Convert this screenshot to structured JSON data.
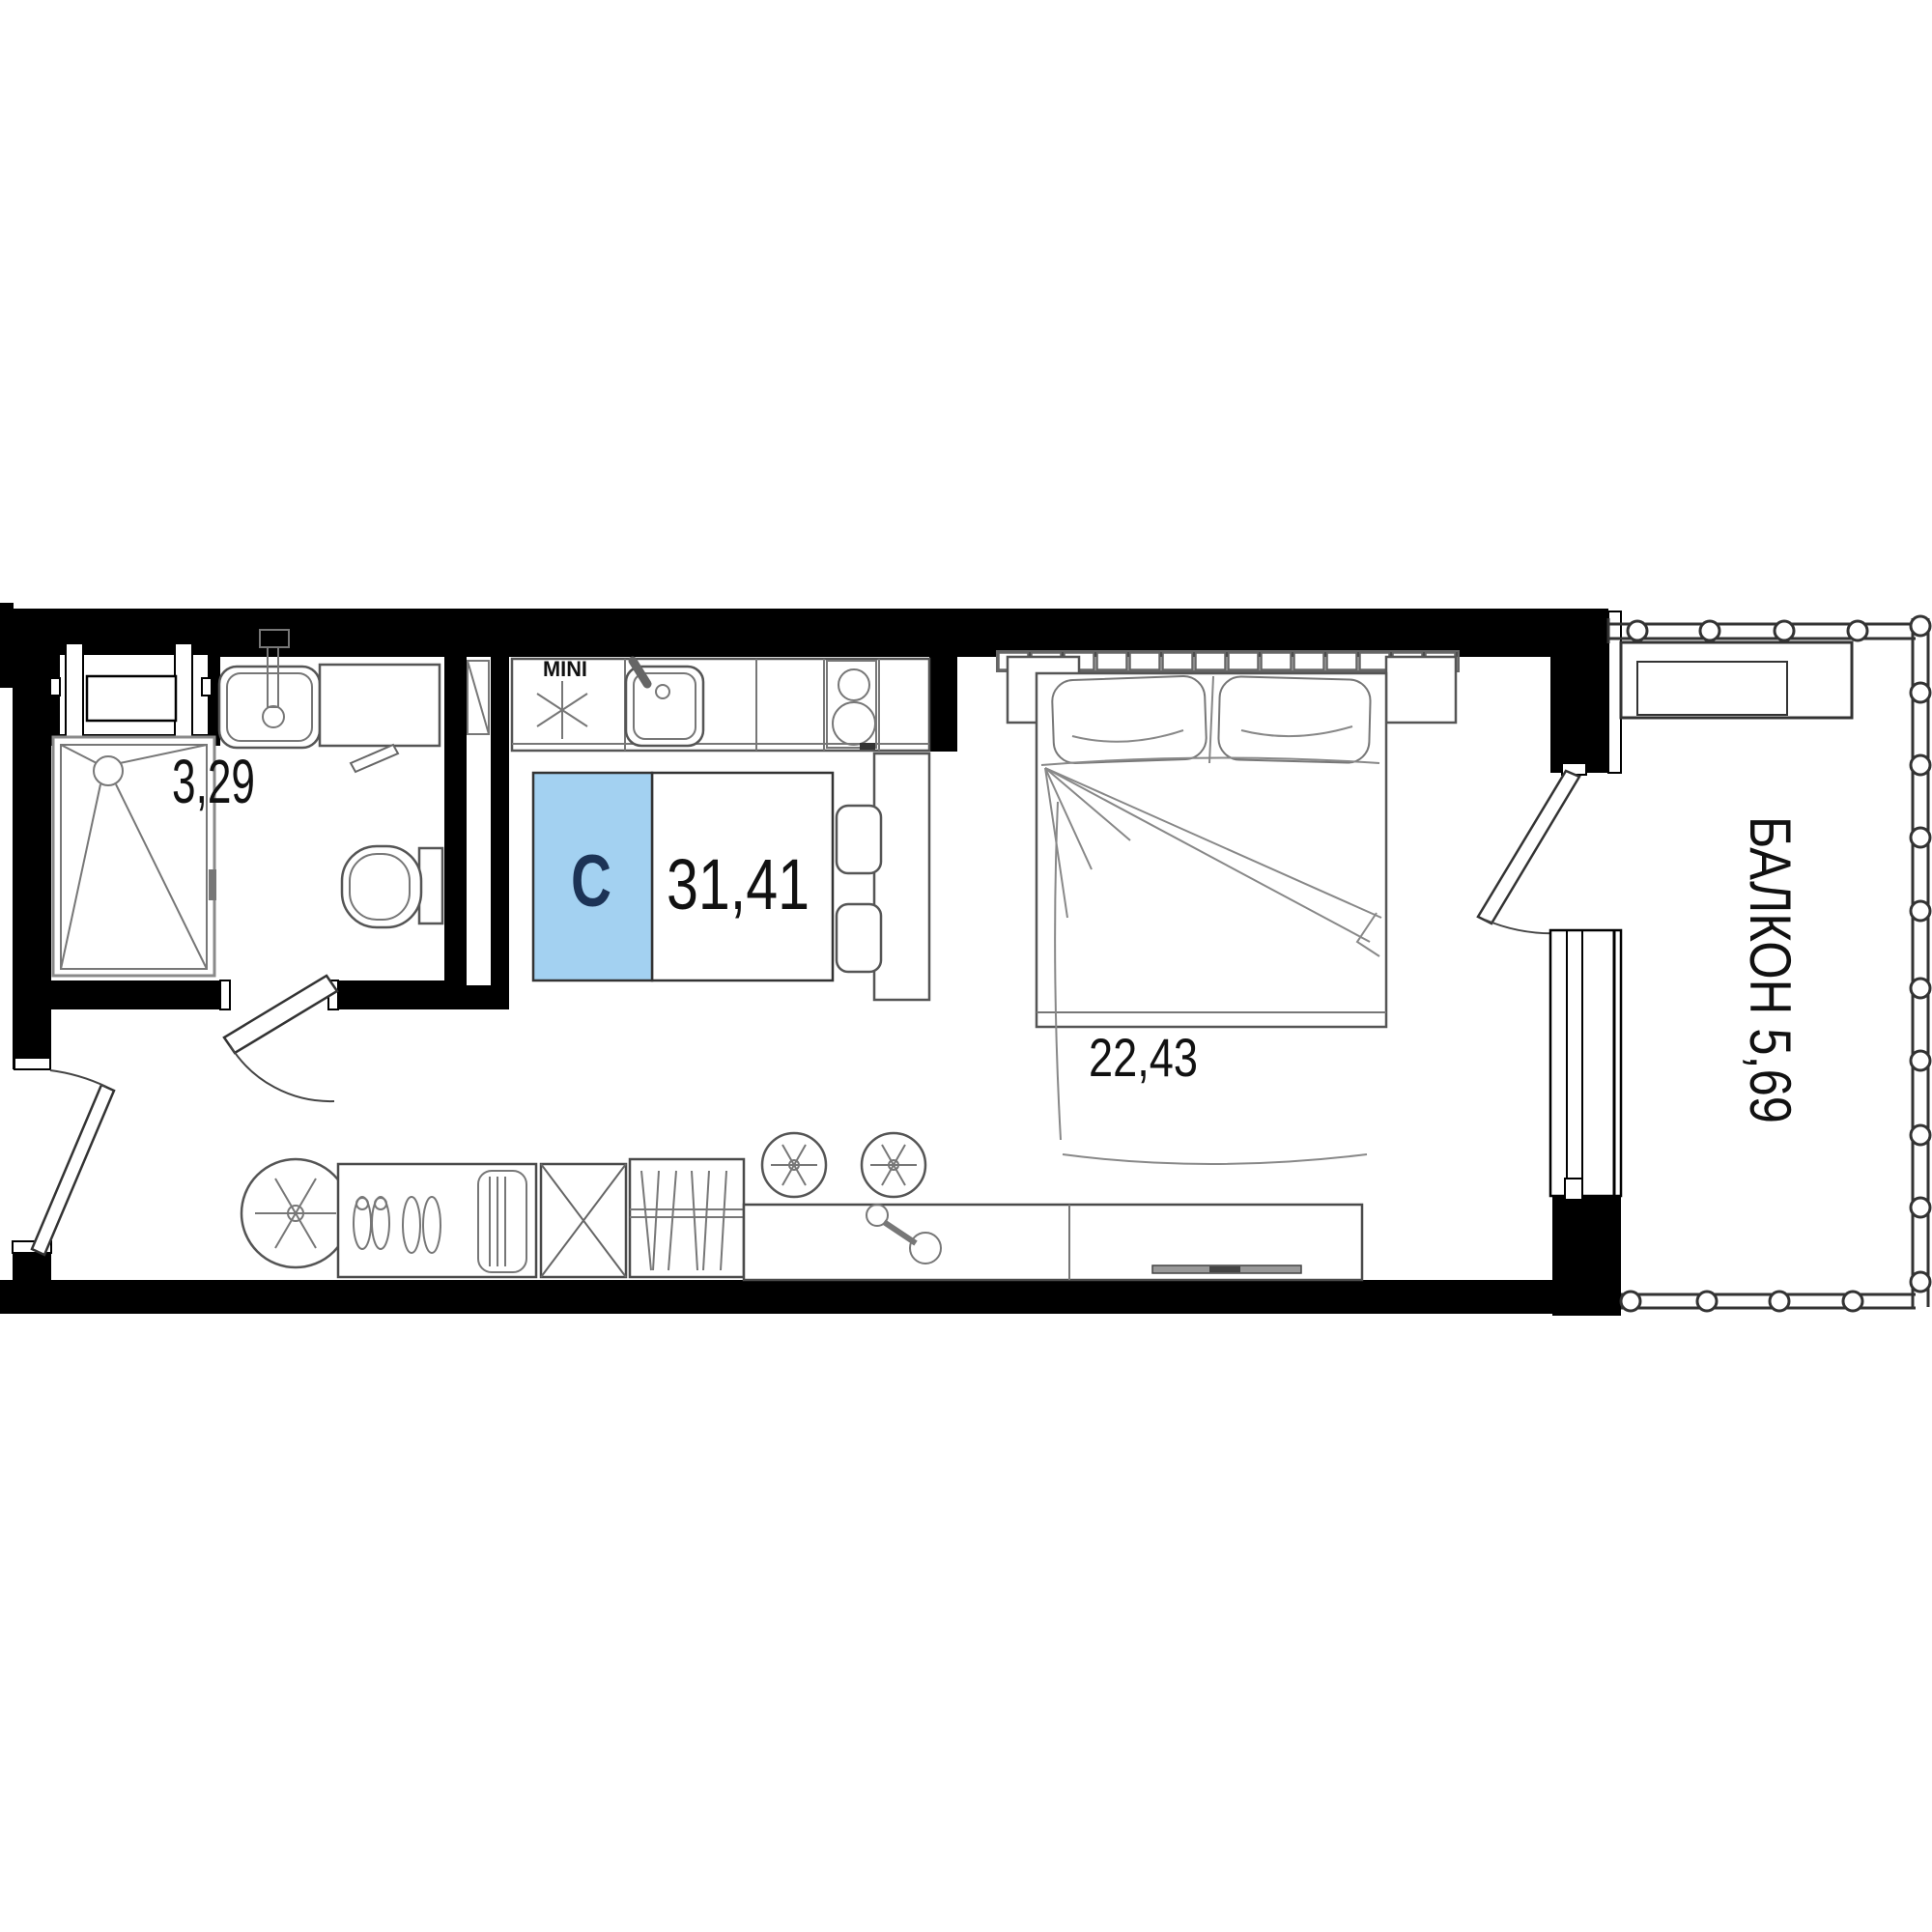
{
  "plan": {
    "unit": {
      "label": "C",
      "total_area": "31,41"
    },
    "bathroom": {
      "area": "3,29"
    },
    "room": {
      "area": "22,43"
    },
    "balcony": {
      "label": "БАЛКОН 5,69"
    },
    "kitchen": {
      "fridge_label": "MINI"
    },
    "colors": {
      "wall": "#000000",
      "unit_fill": "#A3D1F1",
      "unit_letter": "#1C3356",
      "furniture_outline": "#555555"
    }
  }
}
